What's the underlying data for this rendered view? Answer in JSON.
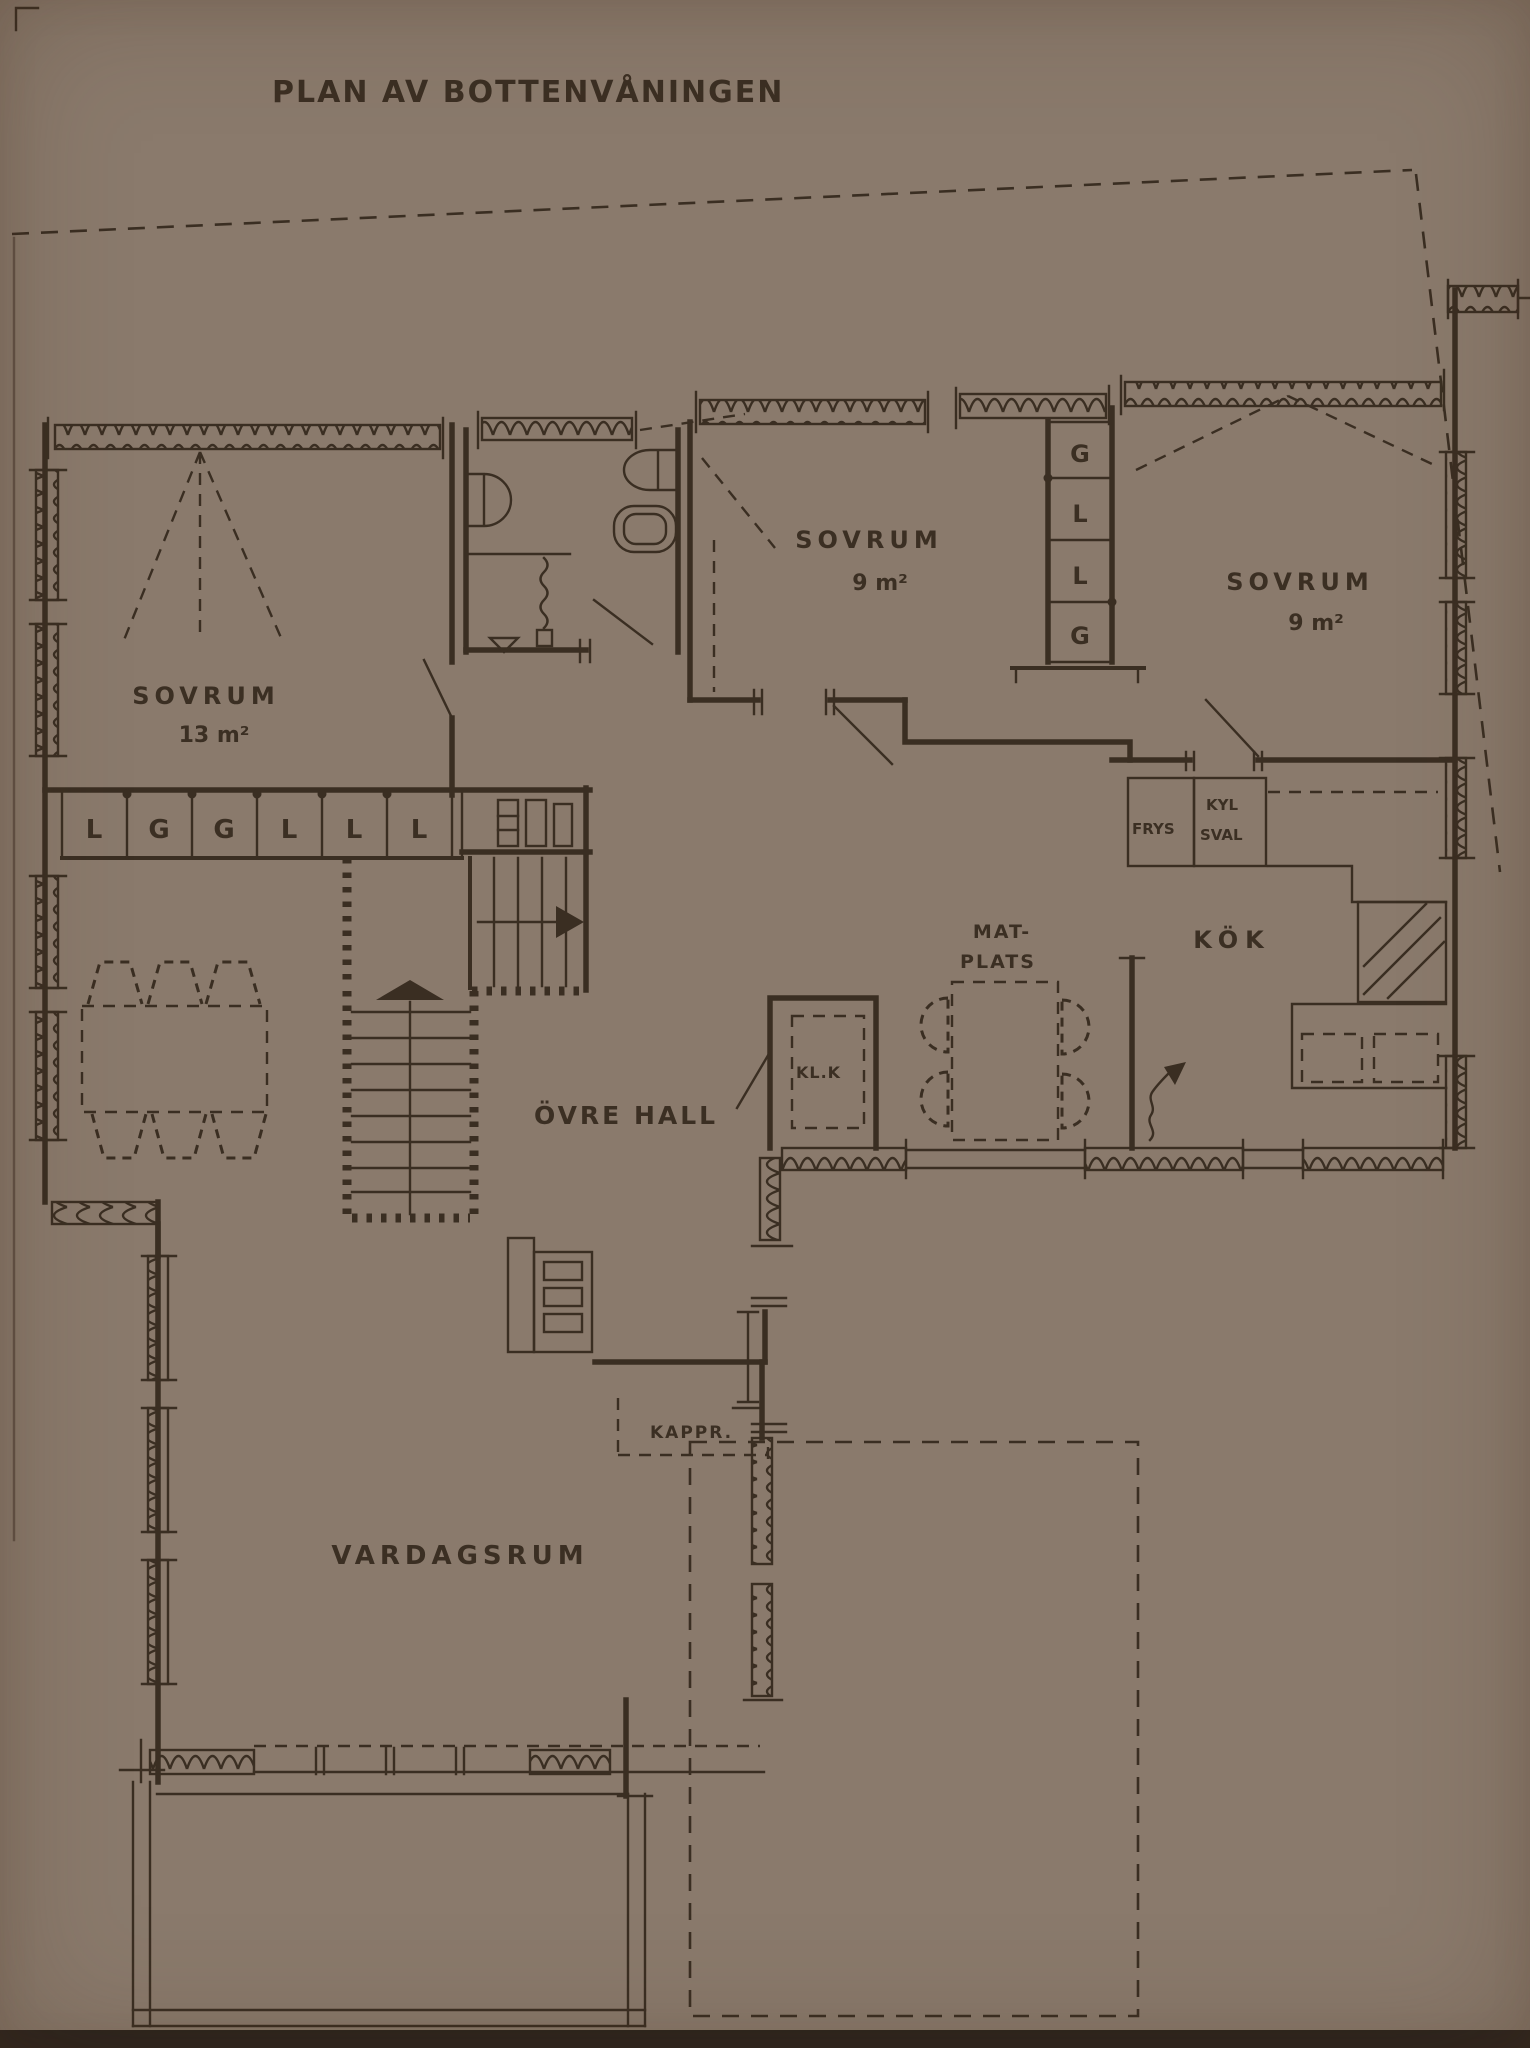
{
  "title": "PLAN AV BOTTENVÅNINGEN",
  "colors": {
    "paper": "#d3c0b2",
    "ink": "#3a2e22"
  },
  "rooms": {
    "sovrum_left": {
      "name": "SOVRUM",
      "area": "13 m²"
    },
    "sovrum_mid": {
      "name": "SOVRUM",
      "area": "9 m²"
    },
    "sovrum_right": {
      "name": "SOVRUM",
      "area": "9 m²"
    },
    "ovre_hall": {
      "name": "ÖVRE HALL"
    },
    "matplats": {
      "line1": "MAT-",
      "line2": "PLATS"
    },
    "kok": {
      "name": "KÖK"
    },
    "klk": {
      "name": "KL.K"
    },
    "kappr": {
      "name": "KAPPR."
    },
    "vardagsrum": {
      "name": "VARDAGSRUM"
    },
    "frys": {
      "name": "FRYS"
    },
    "kyl_sval": {
      "line1": "KYL",
      "line2": "SVAL"
    }
  },
  "closets": {
    "left_row": [
      "L",
      "G",
      "G",
      "L",
      "L",
      "L"
    ],
    "mid_column": [
      "G",
      "L",
      "L",
      "G"
    ]
  }
}
